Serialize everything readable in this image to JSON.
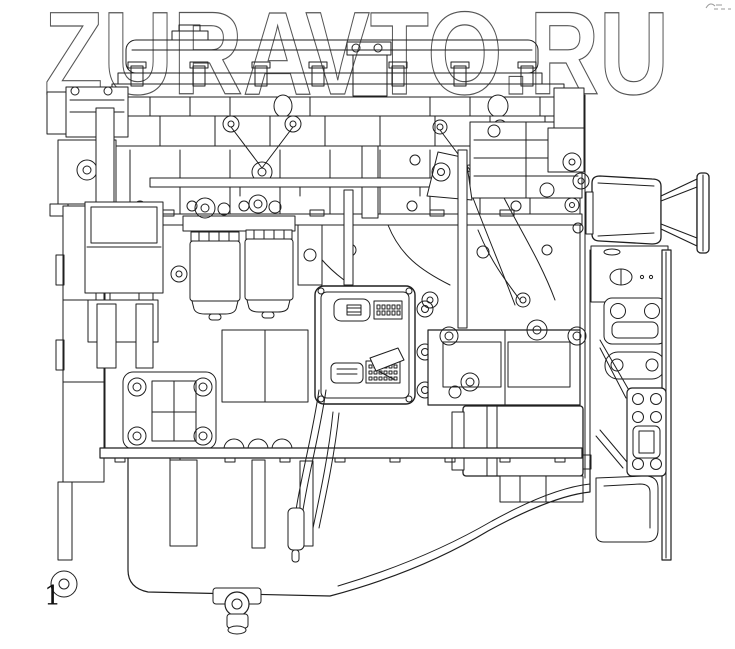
{
  "watermark": {
    "text": "ZURAVTO.RU"
  },
  "figure": {
    "label": "1"
  },
  "colors": {
    "line": "#1f1f1f",
    "watermark_outline": "#555555",
    "background": "#ffffff"
  }
}
